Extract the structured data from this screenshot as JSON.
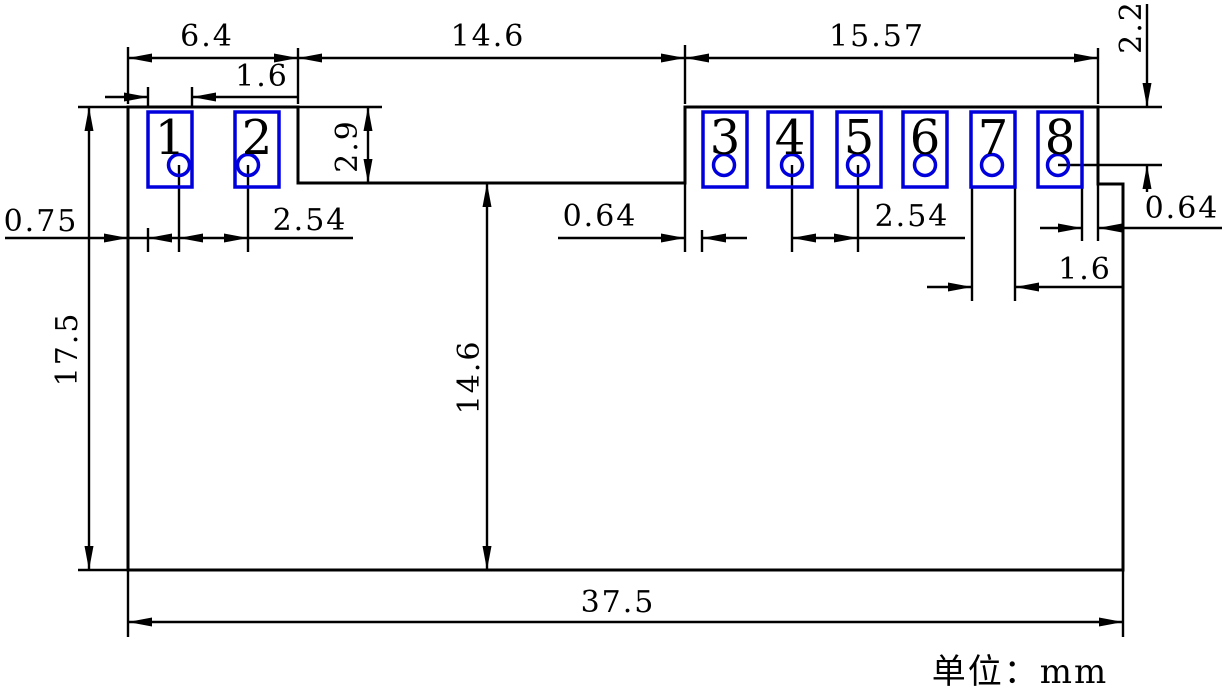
{
  "unit_note": "单位：mm",
  "colors": {
    "line": "#000000",
    "pad": "#0000dd",
    "pad_number": "#c62828",
    "background": "#ffffff"
  },
  "style": {
    "outline_width": 3,
    "pad_stroke_width": 3.5,
    "dim_line_width": 2.4,
    "dim_font_size": 30,
    "pad_font_size": 48,
    "arrow_length": 24,
    "arrow_half_width": 4.5
  },
  "board_outline": "M128 107 L298 107 L298 183 L685 183 L685 107 L1098 107 L1098 184 L1123 184 L1123 570 L128 570 Z",
  "pads": [
    {
      "number": "1",
      "x": 148,
      "y": 112,
      "w": 44,
      "h": 75,
      "hole_cx": 179,
      "hole_cy": 165,
      "hole_r": 10.5
    },
    {
      "number": "2",
      "x": 235,
      "y": 112,
      "w": 44,
      "h": 75,
      "hole_cx": 248,
      "hole_cy": 165,
      "hole_r": 10.5
    },
    {
      "number": "3",
      "x": 703,
      "y": 112,
      "w": 44,
      "h": 75,
      "hole_cx": 724,
      "hole_cy": 165,
      "hole_r": 10.5
    },
    {
      "number": "4",
      "x": 768,
      "y": 112,
      "w": 44,
      "h": 75,
      "hole_cx": 792,
      "hole_cy": 165,
      "hole_r": 10.5
    },
    {
      "number": "5",
      "x": 837,
      "y": 112,
      "w": 44,
      "h": 75,
      "hole_cx": 858,
      "hole_cy": 165,
      "hole_r": 10.5
    },
    {
      "number": "6",
      "x": 903,
      "y": 112,
      "w": 44,
      "h": 75,
      "hole_cx": 925,
      "hole_cy": 165,
      "hole_r": 10.5
    },
    {
      "number": "7",
      "x": 971,
      "y": 112,
      "w": 44,
      "h": 75,
      "hole_cx": 992,
      "hole_cy": 165,
      "hole_r": 10.5
    },
    {
      "number": "8",
      "x": 1038,
      "y": 112,
      "w": 44,
      "h": 75,
      "hole_cx": 1058,
      "hole_cy": 165,
      "hole_r": 10.5
    }
  ],
  "dimensions": [
    {
      "id": "6-4-top",
      "value": "6.4",
      "label": {
        "x": 207,
        "y": 46,
        "rotate": false
      },
      "lines": [
        [
          128,
          58,
          298,
          58
        ],
        [
          128,
          47,
          128,
          104
        ],
        [
          298,
          48,
          298,
          104
        ]
      ],
      "arrows": [
        {
          "x": 128,
          "y": 58,
          "dir": "left"
        },
        {
          "x": 298,
          "y": 58,
          "dir": "right"
        }
      ]
    },
    {
      "id": "14-6-top",
      "value": "14.6",
      "label": {
        "x": 488,
        "y": 46,
        "rotate": false
      },
      "lines": [
        [
          298,
          58,
          685,
          58
        ],
        [
          685,
          45,
          685,
          104
        ]
      ],
      "arrows": [
        {
          "x": 298,
          "y": 58,
          "dir": "left"
        },
        {
          "x": 685,
          "y": 58,
          "dir": "right"
        }
      ]
    },
    {
      "id": "15-57-top",
      "value": "15.57",
      "label": {
        "x": 877,
        "y": 46,
        "rotate": false
      },
      "lines": [
        [
          685,
          58,
          1098,
          58
        ],
        [
          1098,
          48,
          1098,
          104
        ]
      ],
      "arrows": [
        {
          "x": 685,
          "y": 58,
          "dir": "left"
        },
        {
          "x": 1098,
          "y": 58,
          "dir": "right"
        }
      ]
    },
    {
      "id": "1-6-top-left",
      "value": "1.6",
      "label": {
        "x": 262,
        "y": 86,
        "rotate": false
      },
      "lines": [
        [
          105,
          97,
          148,
          97
        ],
        [
          192,
          97,
          298,
          97
        ],
        [
          148,
          87,
          148,
          106
        ],
        [
          192,
          87,
          192,
          106
        ]
      ],
      "arrows": [
        {
          "x": 148,
          "y": 97,
          "dir": "right"
        },
        {
          "x": 192,
          "y": 97,
          "dir": "left"
        }
      ]
    },
    {
      "id": "2-9-step",
      "value": "2.9",
      "label": {
        "x": 357,
        "y": 146,
        "rotate": true
      },
      "lines": [
        [
          368,
          107,
          368,
          183
        ],
        [
          298,
          107,
          382,
          107
        ]
      ],
      "arrows": [
        {
          "x": 368,
          "y": 107,
          "dir": "up"
        },
        {
          "x": 368,
          "y": 183,
          "dir": "down"
        }
      ]
    },
    {
      "id": "2-2-right",
      "value": "2.2",
      "label": {
        "x": 1141,
        "y": 27,
        "rotate": true
      },
      "lines": [
        [
          1147,
          4,
          1147,
          107
        ],
        [
          1147,
          165,
          1147,
          192
        ],
        [
          1098,
          107,
          1162,
          107
        ],
        [
          1058,
          165,
          1162,
          165
        ]
      ],
      "arrows": [
        {
          "x": 1147,
          "y": 107,
          "dir": "down"
        },
        {
          "x": 1147,
          "y": 165,
          "dir": "up"
        }
      ]
    },
    {
      "id": "0-75-left",
      "value": "0.75",
      "label": {
        "x": 41,
        "y": 231,
        "rotate": false
      },
      "lines": [
        [
          5,
          238,
          353,
          238
        ],
        [
          148,
          228,
          148,
          252
        ]
      ],
      "arrows": [
        {
          "x": 128,
          "y": 238,
          "dir": "right"
        },
        {
          "x": 148,
          "y": 238,
          "dir": "left"
        }
      ]
    },
    {
      "id": "2-54-left",
      "value": "2.54",
      "label": {
        "x": 310,
        "y": 230,
        "rotate": false
      },
      "lines": [
        [
          179,
          165,
          179,
          252
        ],
        [
          248,
          165,
          248,
          252
        ]
      ],
      "arrows": [
        {
          "x": 179,
          "y": 238,
          "dir": "left"
        },
        {
          "x": 248,
          "y": 238,
          "dir": "right"
        }
      ]
    },
    {
      "id": "0-64-mid",
      "value": "0.64",
      "label": {
        "x": 600,
        "y": 226,
        "rotate": false
      },
      "lines": [
        [
          558,
          238,
          685,
          238
        ],
        [
          702,
          238,
          747,
          238
        ],
        [
          685,
          183,
          685,
          252
        ],
        [
          702,
          230,
          702,
          252
        ]
      ],
      "arrows": [
        {
          "x": 685,
          "y": 238,
          "dir": "right"
        },
        {
          "x": 702,
          "y": 238,
          "dir": "left"
        }
      ]
    },
    {
      "id": "2-54-right",
      "value": "2.54",
      "label": {
        "x": 912,
        "y": 226,
        "rotate": false
      },
      "lines": [
        [
          792,
          238,
          965,
          238
        ],
        [
          792,
          165,
          792,
          252
        ],
        [
          858,
          165,
          858,
          252
        ]
      ],
      "arrows": [
        {
          "x": 792,
          "y": 238,
          "dir": "left"
        },
        {
          "x": 858,
          "y": 238,
          "dir": "right"
        }
      ]
    },
    {
      "id": "0-64-right",
      "value": "0.64",
      "label": {
        "x": 1182,
        "y": 218,
        "rotate": false
      },
      "lines": [
        [
          1040,
          228,
          1082,
          228
        ],
        [
          1098,
          228,
          1222,
          228
        ],
        [
          1082,
          188,
          1082,
          241
        ],
        [
          1098,
          184,
          1098,
          241
        ]
      ],
      "arrows": [
        {
          "x": 1082,
          "y": 228,
          "dir": "right"
        },
        {
          "x": 1098,
          "y": 228,
          "dir": "left"
        }
      ]
    },
    {
      "id": "1-6-right",
      "value": "1.6",
      "label": {
        "x": 1085,
        "y": 279,
        "rotate": false
      },
      "lines": [
        [
          927,
          287,
          972,
          287
        ],
        [
          1015,
          287,
          1123,
          287
        ],
        [
          972,
          188,
          972,
          301
        ],
        [
          1015,
          188,
          1015,
          301
        ]
      ],
      "arrows": [
        {
          "x": 972,
          "y": 287,
          "dir": "right"
        },
        {
          "x": 1015,
          "y": 287,
          "dir": "left"
        }
      ]
    },
    {
      "id": "17-5-left",
      "value": "17.5",
      "label": {
        "x": 77,
        "y": 349,
        "rotate": true
      },
      "lines": [
        [
          89,
          107,
          89,
          570
        ],
        [
          78,
          107,
          128,
          107
        ],
        [
          78,
          570,
          128,
          570
        ]
      ],
      "arrows": [
        {
          "x": 89,
          "y": 107,
          "dir": "up"
        },
        {
          "x": 89,
          "y": 570,
          "dir": "down"
        }
      ]
    },
    {
      "id": "14-6-mid",
      "value": "14.6",
      "label": {
        "x": 479,
        "y": 377,
        "rotate": true
      },
      "lines": [
        [
          487,
          183,
          487,
          570
        ]
      ],
      "arrows": [
        {
          "x": 487,
          "y": 183,
          "dir": "up"
        },
        {
          "x": 487,
          "y": 570,
          "dir": "down"
        }
      ]
    },
    {
      "id": "37-5-bottom",
      "value": "37.5",
      "label": {
        "x": 618,
        "y": 612,
        "rotate": false
      },
      "lines": [
        [
          128,
          622,
          1123,
          622
        ],
        [
          128,
          570,
          128,
          637
        ],
        [
          1123,
          570,
          1123,
          637
        ]
      ],
      "arrows": [
        {
          "x": 128,
          "y": 622,
          "dir": "left"
        },
        {
          "x": 1123,
          "y": 622,
          "dir": "right"
        }
      ]
    }
  ]
}
